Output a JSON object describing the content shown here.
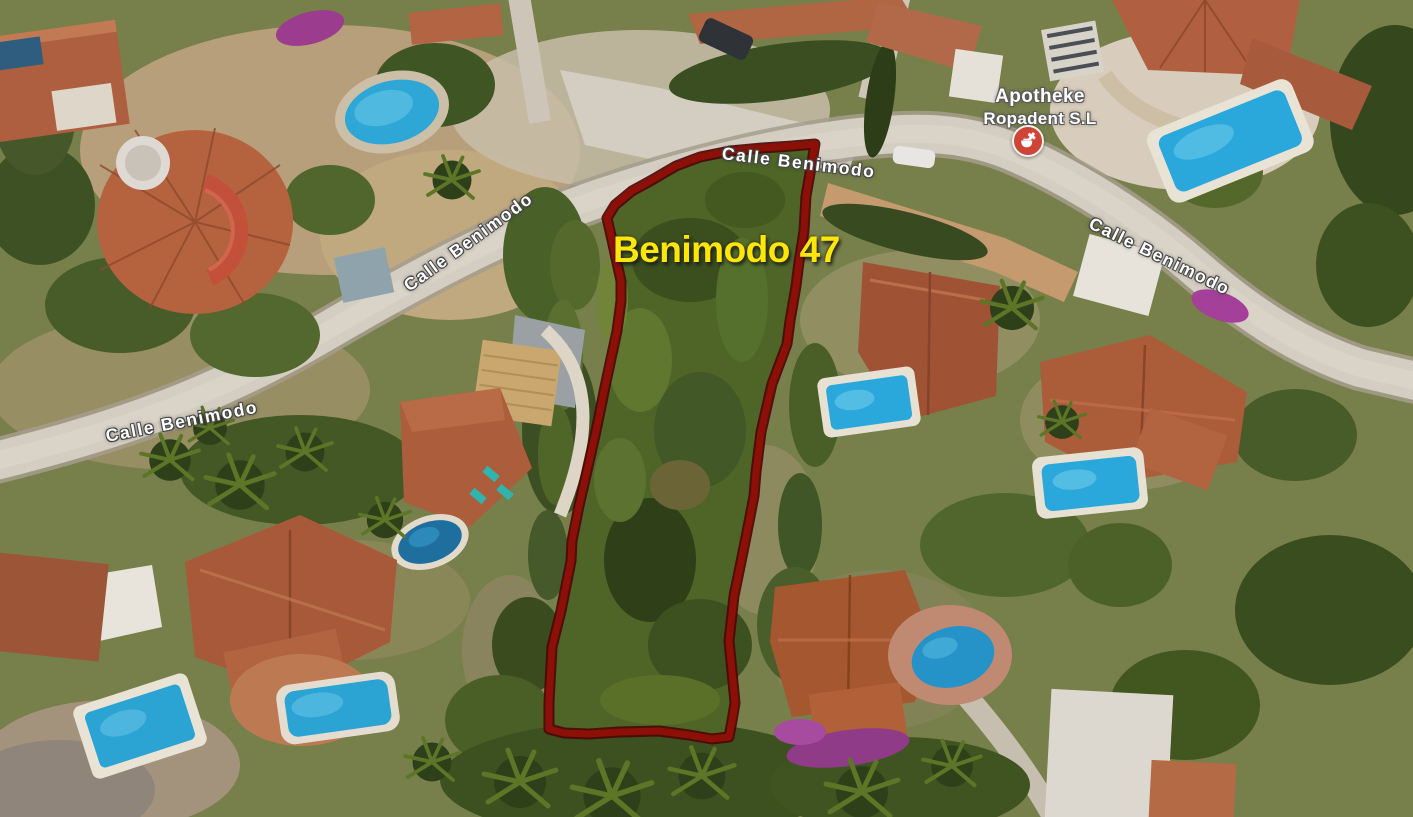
{
  "map": {
    "view": "satellite",
    "plot": {
      "label": "Benimodo 47",
      "label_color": "#FFE606",
      "outline_color": "#8C1007"
    },
    "streets": [
      {
        "text": "Calle Benimodo",
        "position": "west"
      },
      {
        "text": "Calle Benimodo",
        "position": "mid-west-diagonal"
      },
      {
        "text": "Calle Benimodo",
        "position": "top-center"
      },
      {
        "text": "Calle Benimodo",
        "position": "east"
      }
    ],
    "poi": {
      "title": "Apotheke",
      "subtitle": "Ropadent S.L",
      "icon": "pharmacy-icon",
      "icon_color": "#CE4436"
    }
  }
}
